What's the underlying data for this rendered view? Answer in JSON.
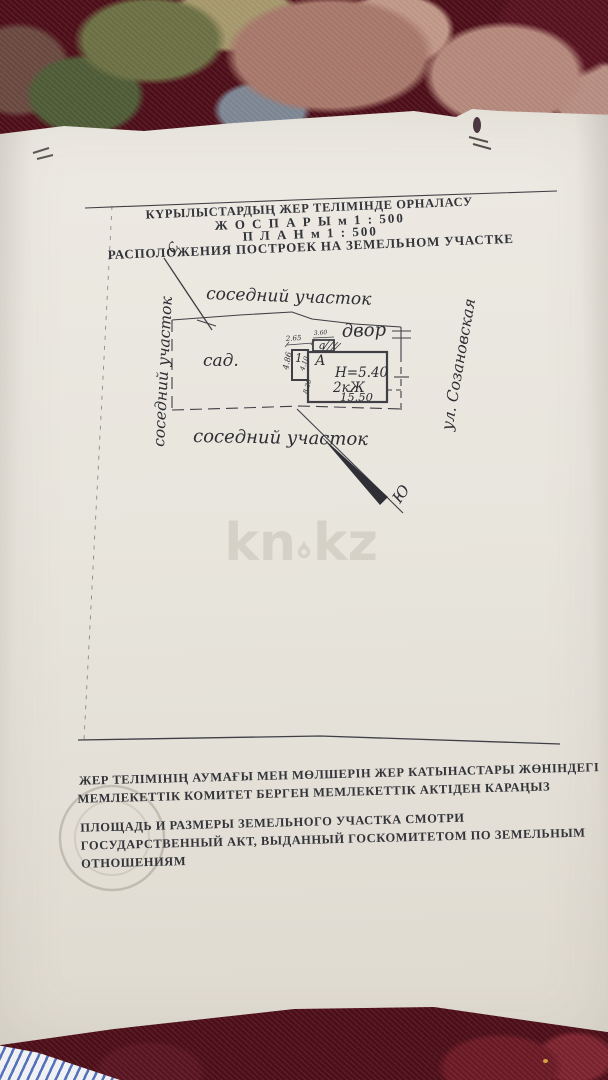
{
  "background": {
    "fabric_color": "#4e0f1a"
  },
  "watermark": {
    "full": "kn.kz",
    "part1": "kn",
    "part2": "kz",
    "color": "#d4d0c5"
  },
  "document": {
    "paper_color": "#e9e6de",
    "ink_color": "#34343b",
    "title": {
      "line1": "КҮРЫЛЫСТАРДЫҢ  ЖЕР  ТЕЛІМІНДЕ  ОРНАЛАСУ",
      "line2": "Ж О С П А Р Ы   м 1 : 500",
      "line3": "П Л А Н   м 1 : 500",
      "line4": "РАСПОЛОЖЕНИЯ  ПОСТРОЕК  НА  ЗЕМЕЛЬНОМ  УЧАСТКЕ"
    },
    "plan": {
      "compass": {
        "north": "С",
        "south": "Ю"
      },
      "labels": {
        "neighbor_top": "соседний участок",
        "neighbor_bottom": "соседний участок",
        "neighbor_left": "соседний участок",
        "street": "ул. Созановская",
        "garden": "сад.",
        "yard": "двор"
      },
      "building": {
        "main": "А",
        "annex": "1",
        "porch": "а",
        "height": "Н=5.40",
        "storeys": "2кЖ",
        "length": "15.50"
      },
      "dimensions": {
        "annex_width": "2.65",
        "annex_height": "4.86",
        "porch_width": "3.60",
        "inner_upper": "4.10",
        "inner_lower": "8.20"
      }
    },
    "notes": {
      "kazakh_line1": "ЖЕР ТЕЛІМІНІҢ АУМАҒЫ МЕН МӨЛШЕРІН ЖЕР КАТЫНАСТАРЫ ЖӨНІНДЕГІ",
      "kazakh_line2": "МЕМЛЕКЕТТІК КОМИТЕТ БЕРГЕН МЕМЛЕКЕТТІК АКТІДЕН КАРАҢЫЗ",
      "russian_line1": "ПЛОЩАДЬ И РАЗМЕРЫ ЗЕМЕЛЬНОГО УЧАСТКА СМОТРИ",
      "russian_line2": "ГОСУДАРСТВЕННЫЙ АКТ, ВЫДАННЫЙ ГОСКОМИТЕТОМ ПО ЗЕМЕЛЬНЫМ",
      "russian_line3": "ОТНОШЕНИЯМ"
    }
  }
}
